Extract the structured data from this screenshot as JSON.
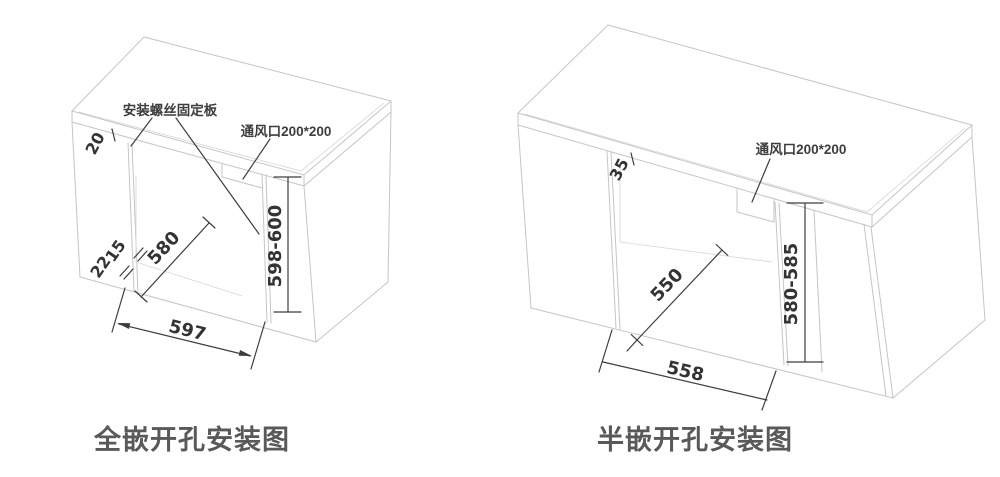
{
  "page": {
    "background": "#ffffff",
    "line_color_cabinet": "#c5c5c5",
    "line_color_dimension": "#3d3d3d"
  },
  "left_diagram": {
    "caption": "全嵌开孔安装图",
    "mount_plate_label": "安装螺丝固定板",
    "vent_label": "通风口200*200",
    "dims": {
      "top_gap": "20",
      "edge_front": "22",
      "edge_side": "15",
      "depth": "580",
      "width": "597",
      "height": "598-600"
    }
  },
  "right_diagram": {
    "caption": "半嵌开孔安装图",
    "vent_label": "通风口200*200",
    "dims": {
      "top_gap": "35",
      "depth": "550",
      "width": "558",
      "height": "580-585"
    }
  }
}
